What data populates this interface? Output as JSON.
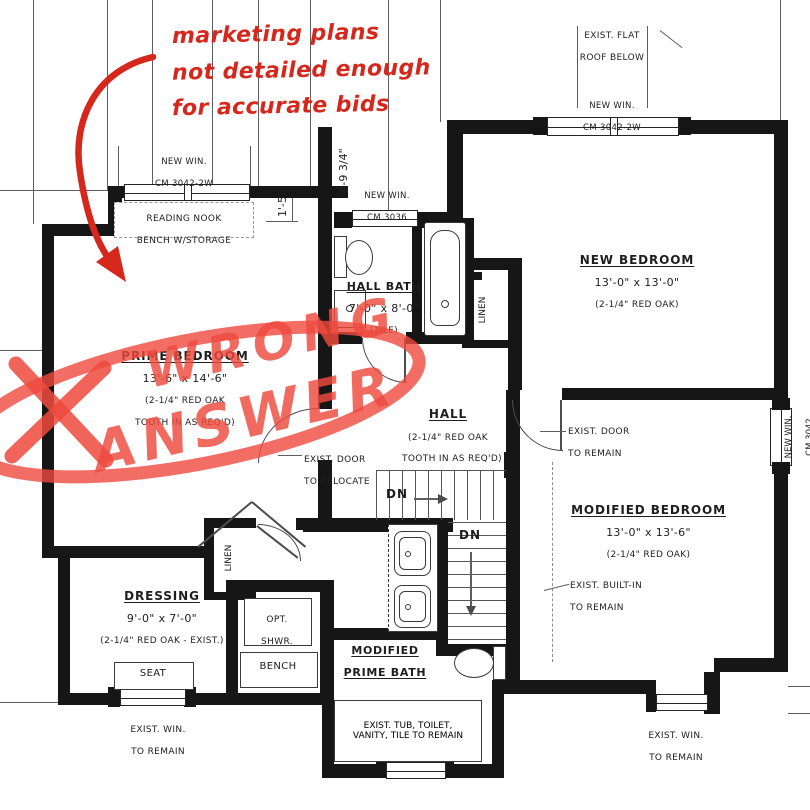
{
  "red_markup": {
    "pen_color": "#d6271c",
    "marker_color": "#ef4a3e",
    "note_lines": [
      "marketing plans",
      "not detailed enough",
      "for accurate bids"
    ],
    "scrawl_word1": "WRONG",
    "scrawl_word2": "ANSWER"
  },
  "rooms": {
    "reading_nook": {
      "l1": "READING NOOK",
      "l2": "BENCH W/STORAGE"
    },
    "new_bedroom": {
      "name": "NEW BEDROOM",
      "dims": "13'-0\" x 13'-0\"",
      "floor": "(2-1/4\" RED OAK)"
    },
    "hall_bath": {
      "name": "HALL BATH",
      "dims": "7'-0\" x 8'-0\"",
      "floor": "(TILE)"
    },
    "prime_bedroom": {
      "name": "PRIME BEDROOM",
      "dims": "13'-6\" x 14'-6\"",
      "floor1": "(2-1/4\" RED OAK",
      "floor2": "TOOTH IN AS REQ'D)"
    },
    "hall": {
      "name": "HALL",
      "floor1": "(2-1/4\" RED OAK",
      "floor2": "TOOTH IN AS REQ'D)"
    },
    "modified_bedroom": {
      "name": "MODIFIED BEDROOM",
      "dims": "13'-0\" x 13'-6\"",
      "floor": "(2-1/4\" RED OAK)"
    },
    "dressing": {
      "name": "DRESSING",
      "dims": "9'-0\" x 7'-0\"",
      "floor": "(2-1/4\" RED OAK - EXIST.)"
    },
    "prime_bath": {
      "l1": "MODIFIED",
      "l2": "PRIME BATH"
    },
    "opt_shower": {
      "l1": "OPT.",
      "l2": "SHWR."
    },
    "bench": {
      "label": "BENCH"
    },
    "seat": {
      "label": "SEAT"
    },
    "linen_hall_bath": {
      "label": "LINEN"
    },
    "linen_dressing": {
      "label": "LINEN"
    }
  },
  "stairs": {
    "dn_upper": "DN",
    "dn_lower": "DN"
  },
  "callouts": {
    "win_nook": {
      "l1": "NEW WIN.",
      "l2": "CM 3042-2W"
    },
    "win_bath": {
      "l1": "NEW WIN.",
      "l2": "CM 3036"
    },
    "win_bedroom": {
      "l1": "NEW WIN.",
      "l2": "CM 3042-2W"
    },
    "win_modified": {
      "l1": "NEW WIN.",
      "l2": "CM 3042"
    },
    "flat_roof": {
      "l1": "EXIST. FLAT",
      "l2": "ROOF BELOW"
    },
    "door_remain": {
      "l1": "EXIST. DOOR",
      "l2": "TO REMAIN"
    },
    "door_relocate": {
      "l1": "EXIST. DOOR",
      "l2": "TO RELOCATE"
    },
    "built_in": {
      "l1": "EXIST. BUILT-IN",
      "l2": "TO REMAIN"
    },
    "tub_remain": {
      "l1": "EXIST. TUB, TOILET,",
      "l2": "VANITY, TILE TO REMAIN"
    },
    "win_remain_left": {
      "l1": "EXIST. WIN.",
      "l2": "TO REMAIN"
    },
    "win_remain_right": {
      "l1": "EXIST. WIN.",
      "l2": "TO REMAIN"
    }
  },
  "dims": {
    "nook_offset": "1'-5\"",
    "bath_offset": "4'-9 3/4\""
  }
}
